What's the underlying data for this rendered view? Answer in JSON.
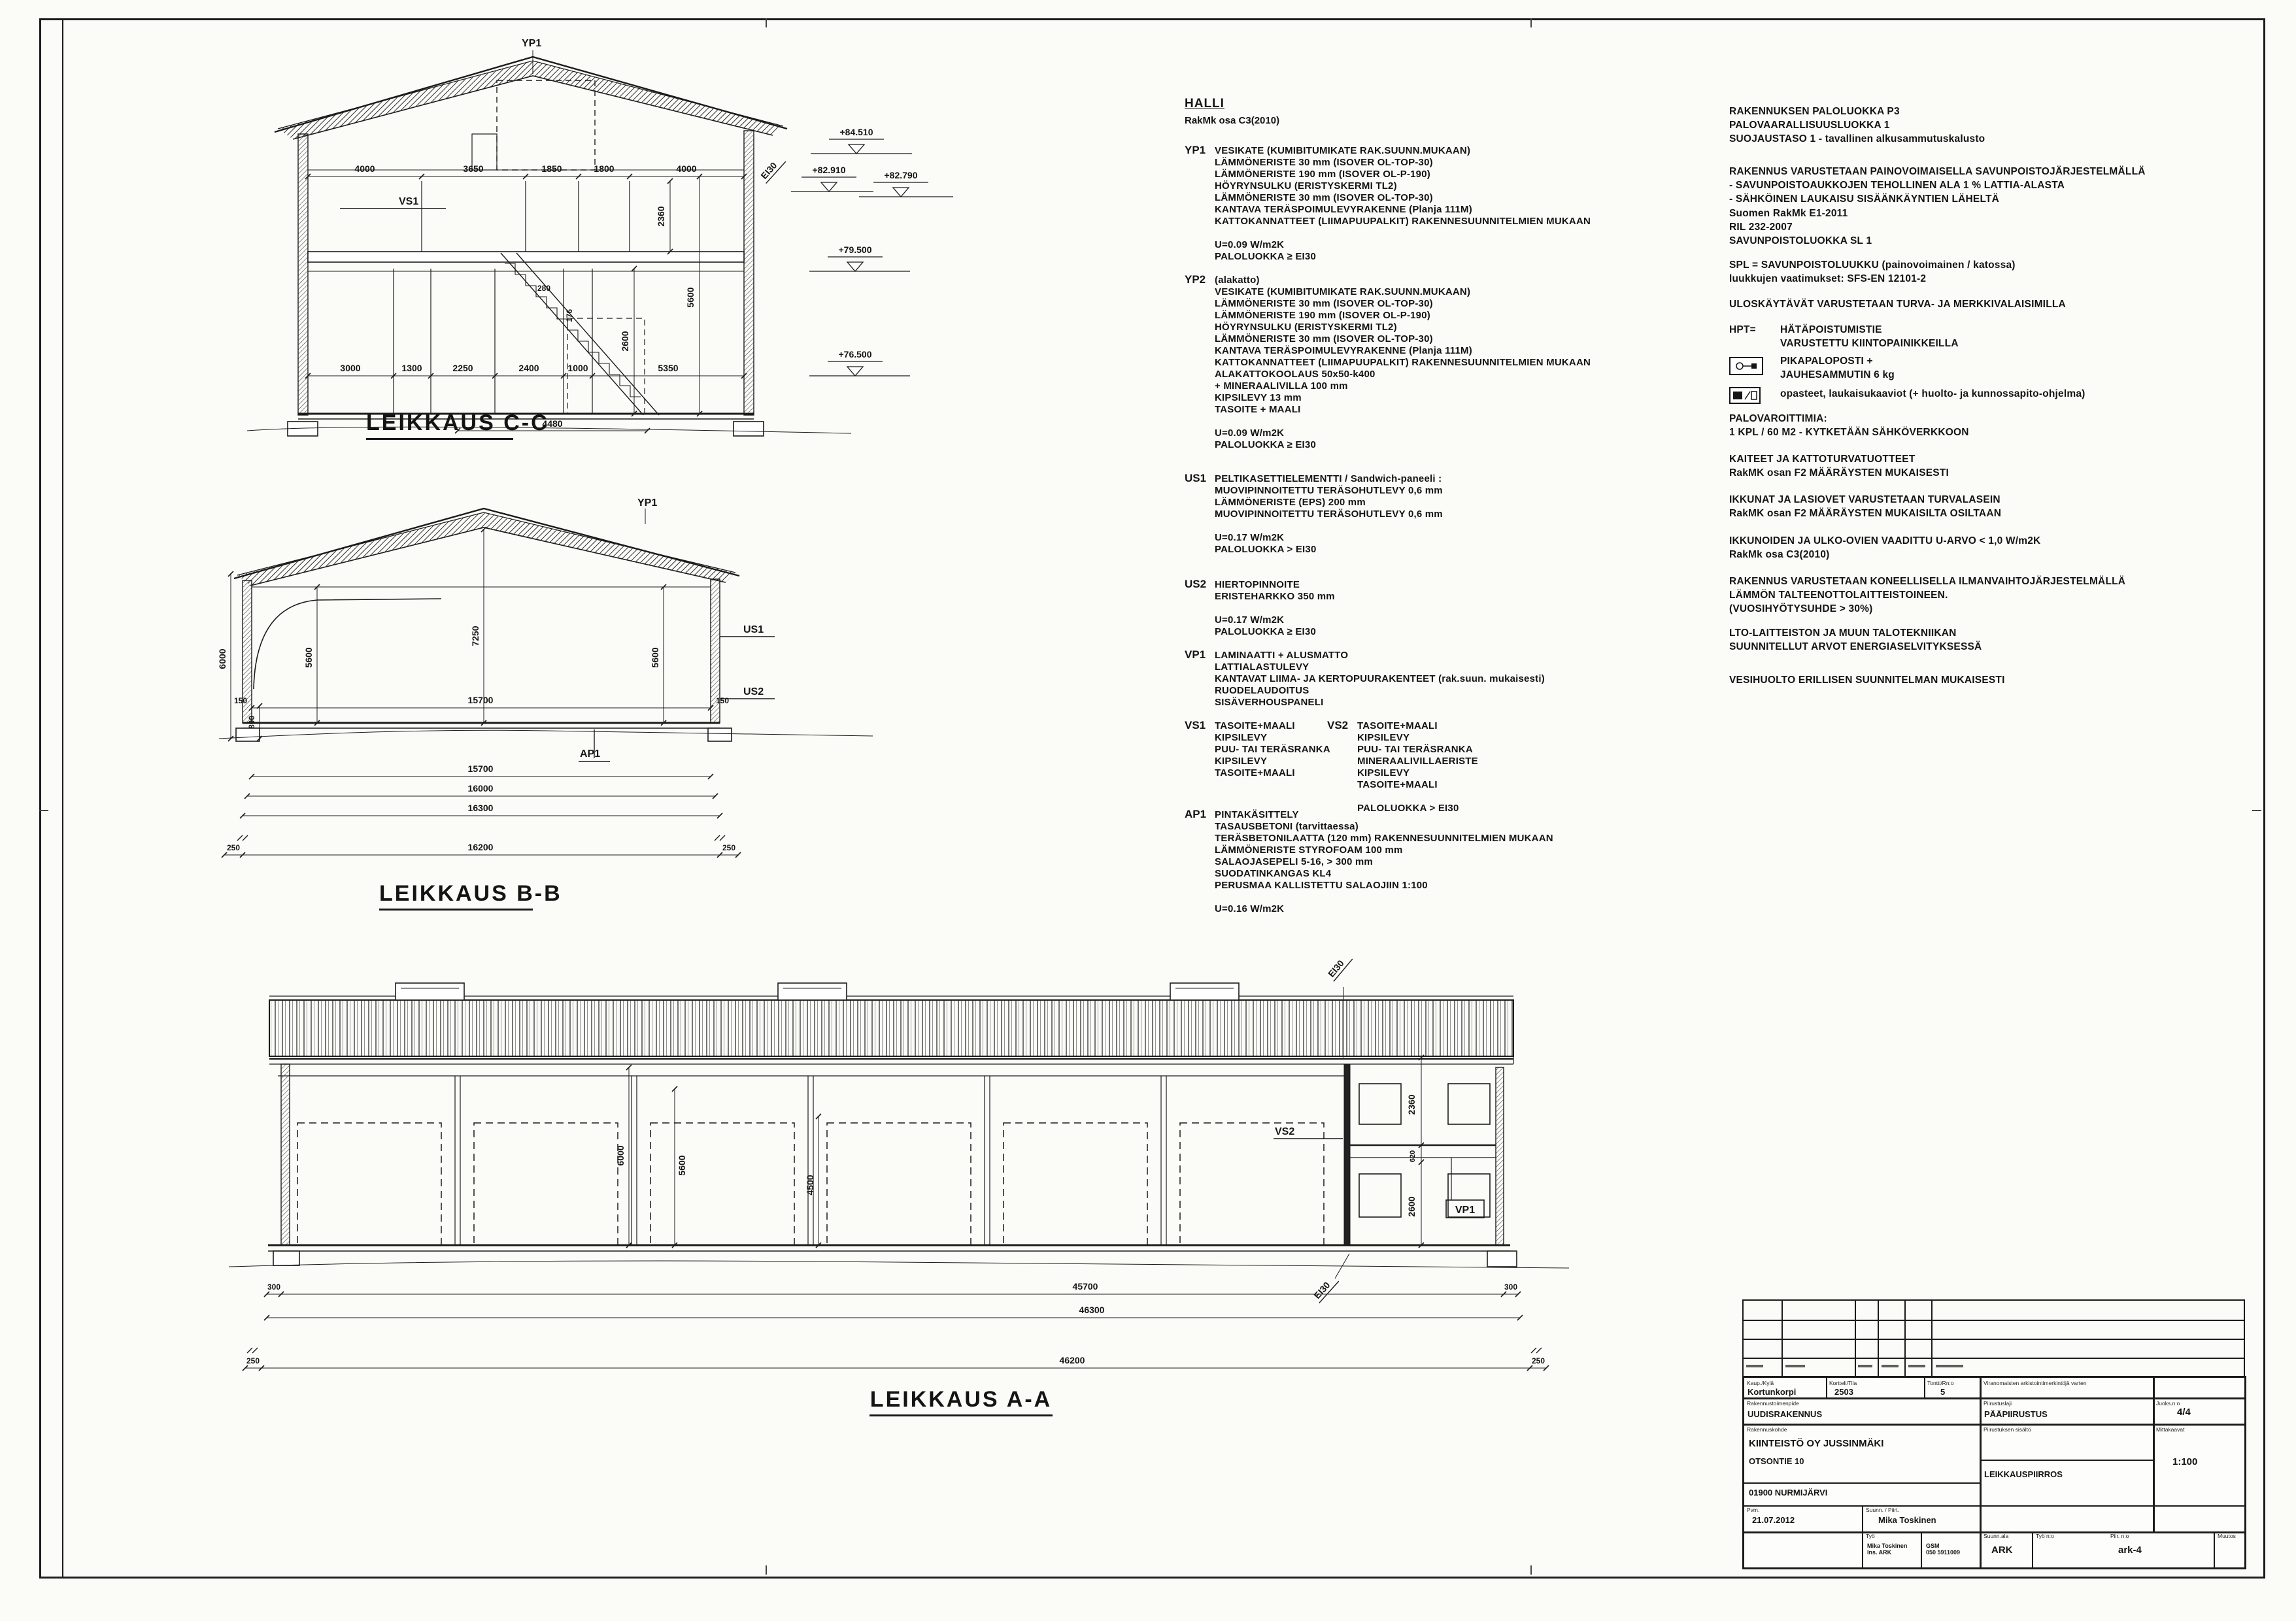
{
  "sections": {
    "cc": {
      "title": "LEIKKAUS C-C",
      "yp1": "YP1",
      "vs1": "VS1",
      "ei30": "EI30",
      "dims_top": [
        "4000",
        "3650",
        "1850",
        "1800",
        "4000"
      ],
      "dims_bottom": [
        "3000",
        "1300",
        "2250",
        "2400",
        "1000",
        "5350"
      ],
      "dim_width": "4480",
      "dim_2360": "2360",
      "dim_2600": "2600",
      "dim_5600": "5600",
      "stair_280": "280",
      "stair_176": "176",
      "elevations": {
        "e1": "+84.510",
        "e2": "+82.910",
        "e3": "+82.790",
        "e4": "+79.500",
        "e5": "+76.500"
      }
    },
    "bb": {
      "title": "LEIKKAUS B-B",
      "yp1": "YP1",
      "us1": "US1",
      "us2": "US2",
      "ap1": "AP1",
      "dim_6000": "6000",
      "dim_800": "800",
      "dim_150l": "150",
      "dim_15700_in": "15700",
      "dim_150r": "150",
      "dim_5600l": "5600",
      "dim_7250": "7250",
      "dim_5600r": "5600",
      "row_15700": "15700",
      "row_16000": "16000",
      "row_16300": "16300",
      "dim_250l": "250",
      "dim_16200": "16200",
      "dim_250r": "250"
    },
    "aa": {
      "title": "LEIKKAUS A-A",
      "ei30_top": "EI30",
      "ei30_bottom": "EI30",
      "vs2": "VS2",
      "vp1": "VP1",
      "dim_6000": "6000",
      "dim_5600": "5600",
      "dim_4500": "4500",
      "dim_2360": "2360",
      "dim_620": "620",
      "dim_2600": "2600",
      "dim_300l": "300",
      "dim_45700": "45700",
      "dim_300r": "300",
      "dim_46300": "46300",
      "dim_250l": "250",
      "dim_46200": "46200",
      "dim_250r": "250"
    }
  },
  "specs": {
    "title": "HALLI",
    "subtitle": "RakMk osa C3(2010)",
    "yp1_code": "YP1",
    "yp1": "VESIKATE (KUMIBITUMIKATE RAK.SUUNN.MUKAAN)\nLÄMMÖNERISTE 30 mm (ISOVER OL-TOP-30)\nLÄMMÖNERISTE 190 mm (ISOVER OL-P-190)\nHÖYRYNSULKU (ERISTYSKERMI TL2)\nLÄMMÖNERISTE 30 mm (ISOVER OL-TOP-30)\nKANTAVA TERÄSPOIMULEVYRAKENNE (Planja 111M)\nKATTOKANNATTEET (LIIMAPUUPALKIT) RAKENNESUUNNITELMIEN MUKAAN\n\nU=0.09 W/m2K\nPALOLUOKKA ≥ EI30",
    "yp2_code": "YP2",
    "yp2": "(alakatto)\nVESIKATE (KUMIBITUMIKATE RAK.SUUNN.MUKAAN)\nLÄMMÖNERISTE 30 mm (ISOVER OL-TOP-30)\nLÄMMÖNERISTE 190 mm (ISOVER OL-P-190)\nHÖYRYNSULKU (ERISTYSKERMI TL2)\nLÄMMÖNERISTE 30 mm (ISOVER OL-TOP-30)\nKANTAVA TERÄSPOIMULEVYRAKENNE (Planja 111M)\nKATTOKANNATTEET (LIIMAPUUPALKIT) RAKENNESUUNNITELMIEN MUKAAN\nALAKATTOKOOLAUS 50x50-k400\n+ MINERAALIVILLA 100 mm\nKIPSILEVY 13 mm\nTASOITE + MAALI\n\nU=0.09 W/m2K\nPALOLUOKKA ≥ EI30",
    "us1_code": "US1",
    "us1": "PELTIKASETTIELEMENTTI / Sandwich-paneeli :\nMUOVIPINNOITETTU TERÄSOHUTLEVY 0,6 mm\nLÄMMÖNERISTE (EPS) 200 mm\nMUOVIPINNOITETTU TERÄSOHUTLEVY 0,6 mm\n\nU=0.17 W/m2K\nPALOLUOKKA > EI30",
    "us2_code": "US2",
    "us2": "HIERTOPINNOITE\nERISTEHARKKO 350 mm\n\nU=0.17 W/m2K\nPALOLUOKKA ≥ EI30",
    "vp1_code": "VP1",
    "vp1": "LAMINAATTI + ALUSMATTO\nLATTIALASTULEVY\nKANTAVAT LIIMA- JA KERTOPUURAKENTEET (rak.suun. mukaisesti)\nRUODELAUDOITUS\nSISÄVERHOUSPANELI",
    "vs1_code": "VS1",
    "vs1": "TASOITE+MAALI\nKIPSILEVY\nPUU- TAI TERÄSRANKA\nKIPSILEVY\nTASOITE+MAALI",
    "vs2_code": "VS2",
    "vs2": "TASOITE+MAALI\nKIPSILEVY\nPUU- TAI TERÄSRANKA\nMINERAALIVILLAERISTE\nKIPSILEVY\nTASOITE+MAALI\n\nPALOLUOKKA > EI30",
    "ap1_code": "AP1",
    "ap1": "PINTAKÄSITTELY\nTASAUSBETONI (tarvittaessa)\nTERÄSBETONILAATTA (120 mm) RAKENNESUUNNITELMIEN MUKAAN\nLÄMMÖNERISTE STYROFOAM 100 mm\nSALAOJASEPELI 5-16, > 300 mm\nSUODATINKANGAS KL4\nPERUSMAA KALLISTETTU SALAOJIIN 1:100\n\nU=0.16 W/m2K"
  },
  "notes": {
    "p1": "RAKENNUKSEN PALOLUOKKA  P3\nPALOVAARALLISUUSLUOKKA 1\nSUOJAUSTASO 1 - tavallinen alkusammutuskalusto",
    "p2": "RAKENNUS VARUSTETAAN PAINOVOIMAISELLA SAVUNPOISTOJÄRJESTELMÄLLÄ\n- SAVUNPOISTOAUKKOJEN TEHOLLINEN ALA 1 % LATTIA-ALASTA\n- SÄHKÖINEN LAUKAISU SISÄÄNKÄYNTIEN LÄHELTÄ",
    "p3": "Suomen RakMk E1-2011\nRIL 232-2007\nSAVUNPOISTOLUOKKA SL 1",
    "p4": "SPL = SAVUNPOISTOLUUKKU (painovoimainen / katossa)\nluukkujen vaatimukset: SFS-EN 12101-2",
    "p5": "ULOSKÄYTÄVÄT VARUSTETAAN TURVA- JA MERKKIVALAISIMILLA",
    "hpt_code": "HPT=",
    "hpt": "HÄTÄPOISTUMISTIE\nVARUSTETTU KIINTOPAINIKKEILLA",
    "fire": "PIKAPALOPOSTI +\nJAUHESAMMUTIN 6 kg",
    "signs": "opasteet, laukaisukaaviot (+ huolto- ja kunnossapito-ohjelma)",
    "p9": "PALOVAROITTIMIA:\n1 KPL / 60 M2 - KYTKETÄÄN SÄHKÖVERKKOON",
    "p10": "KAITEET JA KATTOTURVATUOTTEET\nRakMK osan F2 MÄÄRÄYSTEN MUKAISESTI",
    "p11": "IKKUNAT JA LASIOVET VARUSTETAAN TURVALASEIN\nRakMK osan F2 MÄÄRÄYSTEN MUKAISILTA OSILTAAN",
    "p12": "IKKUNOIDEN JA ULKO-OVIEN VAADITTU U-ARVO < 1,0 W/m2K\nRakMk osa C3(2010)",
    "p13": "RAKENNUS VARUSTETAAN KONEELLISELLA ILMANVAIHTOJÄRJESTELMÄLLÄ\nLÄMMÖN TALTEENOTTOLAITTEISTOINEEN.\n(VUOSIHYÖTYSUHDE > 30%)",
    "p14": "LTO-LAITTEISTON JA MUUN TALOTEKNIIKAN\nSUUNNITELLUT ARVOT ENERGIASELVITYKSESSÄ",
    "p15": "VESIHUOLTO ERILLISEN SUUNNITELMAN MUKAISESTI"
  },
  "titleblock": {
    "labels": {
      "kyla": "Kaup./Kylä",
      "kortteli": "Kortteli/Tila",
      "tontti": "Tontti/Rn:o",
      "arkisto": "Viranomaisten arkistointimerkintöjä varten",
      "toimenpide": "Rakennustoimenpide",
      "piirlaji": "Piirustuslaji",
      "lehti": "Juoks.n:o",
      "kohde": "Rakennuskohde",
      "sisalto": "Piirustuksen sisältö",
      "mittakaava": "Mittakaavat",
      "pvm": "Pvm.",
      "suunn": "Suunn. / Piirt.",
      "tyo": "Työ",
      "ala": "Suunn.ala",
      "tyonro": "Työ n:o",
      "piirnro": "Piir. n:o",
      "muutos": "Muutos"
    },
    "values": {
      "kyla": "Kortunkorpi",
      "kortteli": "2503",
      "tontti": "5",
      "toimenpide": "UUDISRAKENNUS",
      "piirlaji": "PÄÄPIIRUSTUS",
      "lehti": "4/4",
      "kohde1": "KIINTEISTÖ OY JUSSINMÄKI",
      "kohde2": "OTSONTIE 10",
      "kohde3": "01900 NURMIJÄRVI",
      "sisalto": "LEIKKAUSPIIRROS",
      "mittakaava": "1:100",
      "pvm": "21.07.2012",
      "suunn": "Mika Toskinen",
      "sig": "Mika Toskinen\nIns. ARK",
      "gsm": "GSM\n050 5911009",
      "ala": "ARK",
      "piirnro": "ark-4"
    }
  }
}
